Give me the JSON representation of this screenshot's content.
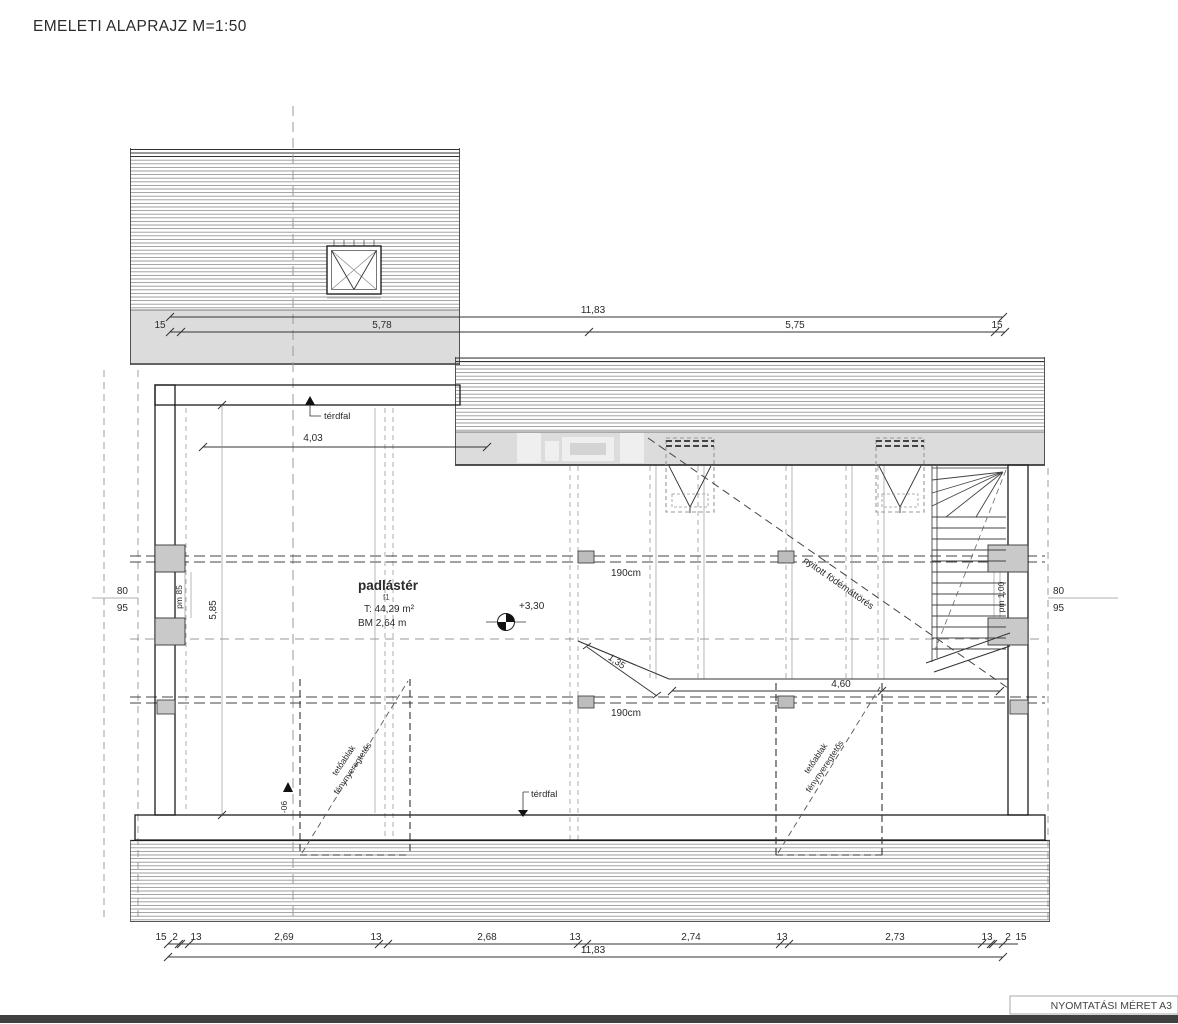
{
  "title": "EMELETI ALAPRAJZ M=1:50",
  "footer": {
    "print_size_label": "NYOMTATÁSI MÉRET A3"
  },
  "room": {
    "name": "padlástér",
    "code": "f1",
    "area": "T: 44,29 m²",
    "height": "BM 2,64 m",
    "level": "+3,30"
  },
  "annotations": {
    "knee_wall_top": "térdfal",
    "knee_wall_bottom": "térdfal",
    "headroom_line_1": "190cm",
    "headroom_line_2": "190cm",
    "slab_opening": "nyitott födémáttörés",
    "roof_window_label_line1": "tetőablak",
    "roof_window_label_line2": "fénynyeregtetős",
    "parapet_left": "pm 85",
    "parapet_right": "pm 1,00",
    "slope_marker": "-06"
  },
  "dimensions": {
    "top": {
      "overall": "11,83",
      "segments": [
        "15",
        "5,78",
        "5,75",
        "15"
      ]
    },
    "bottom": {
      "overall": "11,83",
      "segments": [
        "15",
        "2",
        "13",
        "2,69",
        "13",
        "2,68",
        "13",
        "2,74",
        "13",
        "2,73",
        "13",
        "2",
        "15"
      ]
    },
    "left": {
      "offset_a": "80",
      "offset_b": "95",
      "width": "4,03",
      "depth": "5,85"
    },
    "right": {
      "offset_a": "80",
      "offset_b": "95"
    },
    "opening": {
      "diagonal": "1,35",
      "length": "4,60"
    }
  }
}
